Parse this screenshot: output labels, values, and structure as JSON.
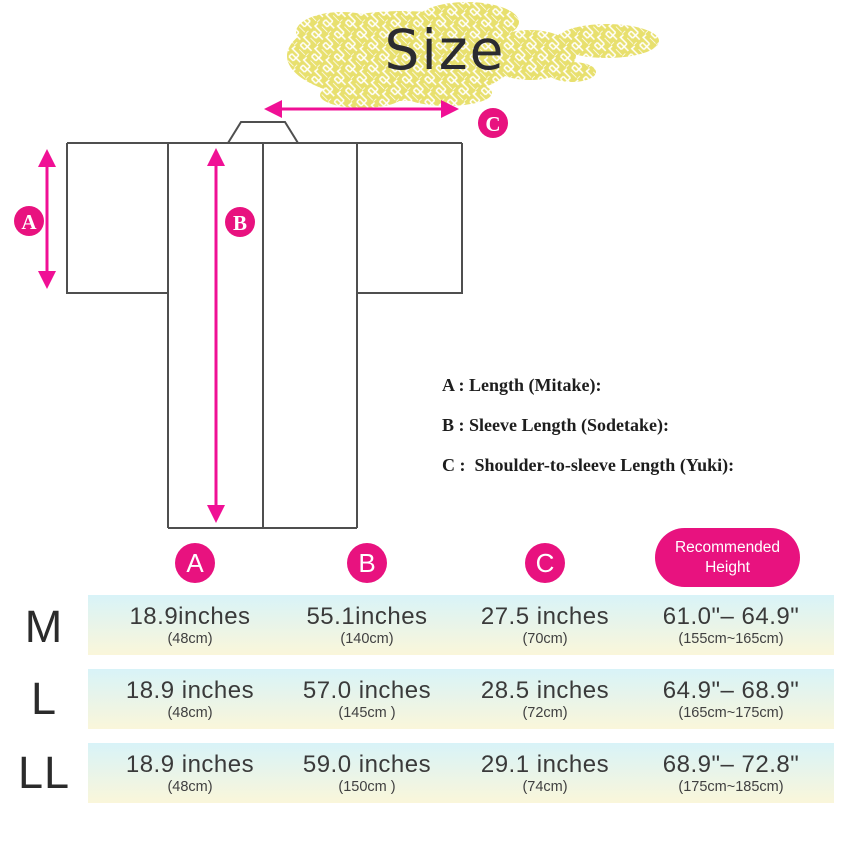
{
  "title": "Size",
  "colors": {
    "pink": "#e8127f",
    "arrow_pink": "#f01095",
    "outline_gray": "#4f4f4f",
    "cloud_yellow": "#e8e06e",
    "row_gradient_top": "#d8f3f8",
    "row_gradient_bottom": "#faf6da"
  },
  "diagram": {
    "marker_a": "A",
    "marker_b": "B",
    "marker_c": "C",
    "legend": {
      "a": "A : Length (Mitake):",
      "b": "B : Sleeve Length (Sodetake):",
      "c": "C :  Shoulder-to-sleeve Length (Yuki):"
    }
  },
  "table": {
    "header": {
      "col_a": "A",
      "col_b": "B",
      "col_c": "C",
      "recommended": "Recommended Height"
    },
    "rows": [
      {
        "size": "M",
        "length_in": "18.9inches",
        "length_cm": "(48cm)",
        "sleeve_in": "55.1inches",
        "sleeve_cm": "(140cm)",
        "yuki_in": "27.5 inches",
        "yuki_cm": "(70cm)",
        "height_in": "61.0\"– 64.9\"",
        "height_cm": "(155cm~165cm)"
      },
      {
        "size": "L",
        "length_in": "18.9 inches",
        "length_cm": "(48cm)",
        "sleeve_in": "57.0 inches",
        "sleeve_cm": "(145cm )",
        "yuki_in": "28.5 inches",
        "yuki_cm": "(72cm)",
        "height_in": "64.9\"– 68.9\"",
        "height_cm": "(165cm~175cm)"
      },
      {
        "size": "LL",
        "length_in": "18.9 inches",
        "length_cm": "(48cm)",
        "sleeve_in": "59.0 inches",
        "sleeve_cm": "(150cm )",
        "yuki_in": "29.1 inches",
        "yuki_cm": "(74cm)",
        "height_in": "68.9\"– 72.8\"",
        "height_cm": "(175cm~185cm)"
      }
    ]
  }
}
